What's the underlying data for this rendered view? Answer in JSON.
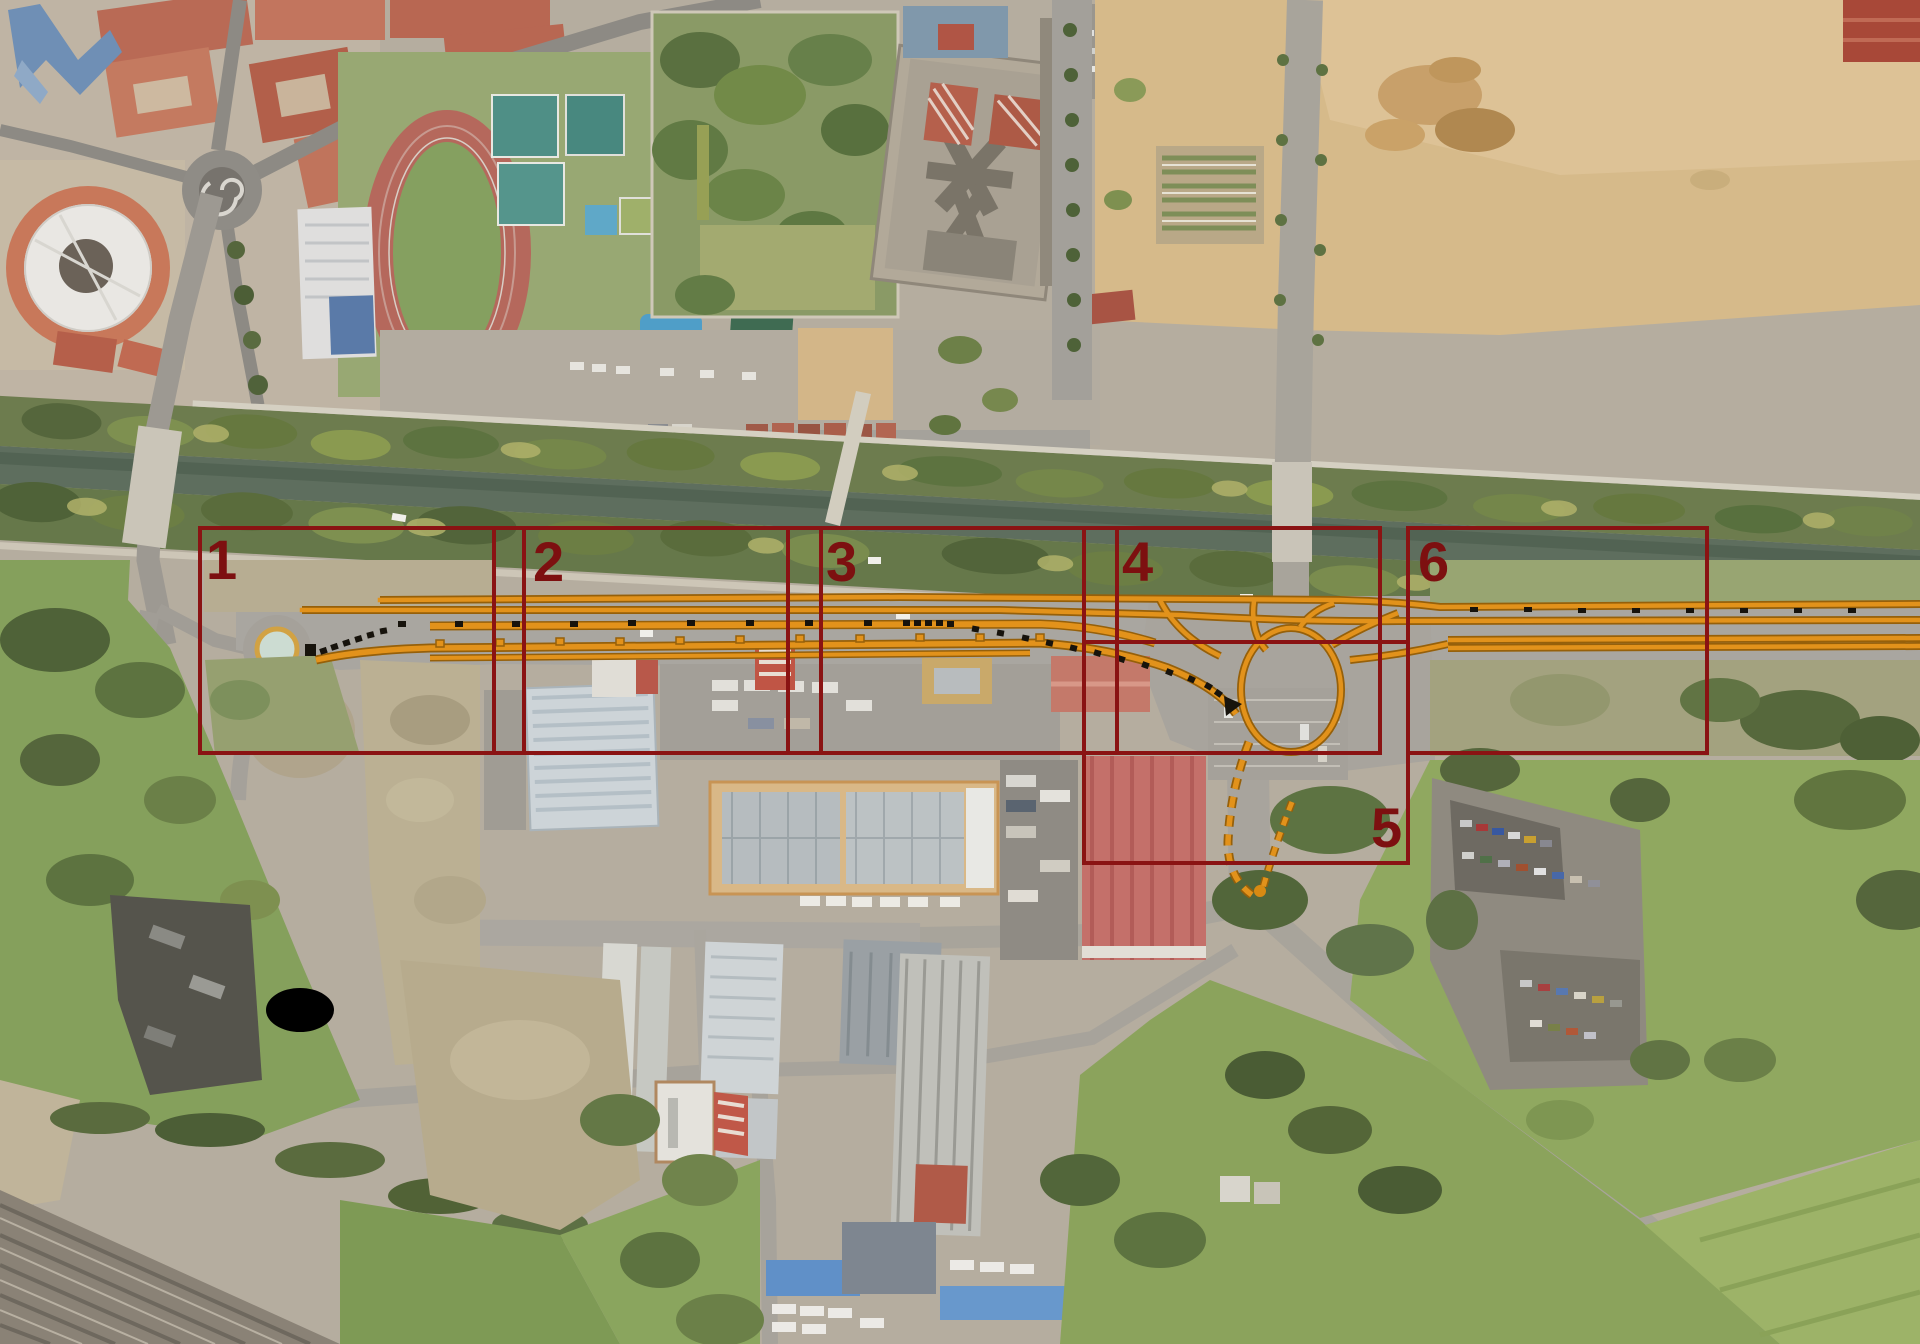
{
  "overlay": {
    "box_color": "#8a1313",
    "label_color": "#7d1010",
    "alignment_color": "#e2921b",
    "alignment_casing_color": "#96600a",
    "marker_color": "#17130c",
    "existing_roundabout_ring_color": "#d2a243",
    "sections": [
      {
        "id": "section-1",
        "label": "1"
      },
      {
        "id": "section-2",
        "label": "2"
      },
      {
        "id": "section-3",
        "label": "3"
      },
      {
        "id": "section-4",
        "label": "4"
      },
      {
        "id": "section-5",
        "label": "5"
      },
      {
        "id": "section-6",
        "label": "6"
      }
    ]
  },
  "photo": {
    "kind": "aerial-orthophoto",
    "palette": {
      "ground": "#b3ab9d",
      "sand_field": "#d6ba8a",
      "canal_water": "#5e6e5e",
      "tree_dark": "#4f6238",
      "tree_light": "#8a9a50",
      "meadow": "#85a05c",
      "road": "#a7a39b",
      "red_roof": "#b86752",
      "track_red": "#b5685c",
      "warehouse_gray": "#cdd4d8",
      "hall_tan": "#d9b887",
      "big_building_pink": "#c4706a"
    }
  }
}
